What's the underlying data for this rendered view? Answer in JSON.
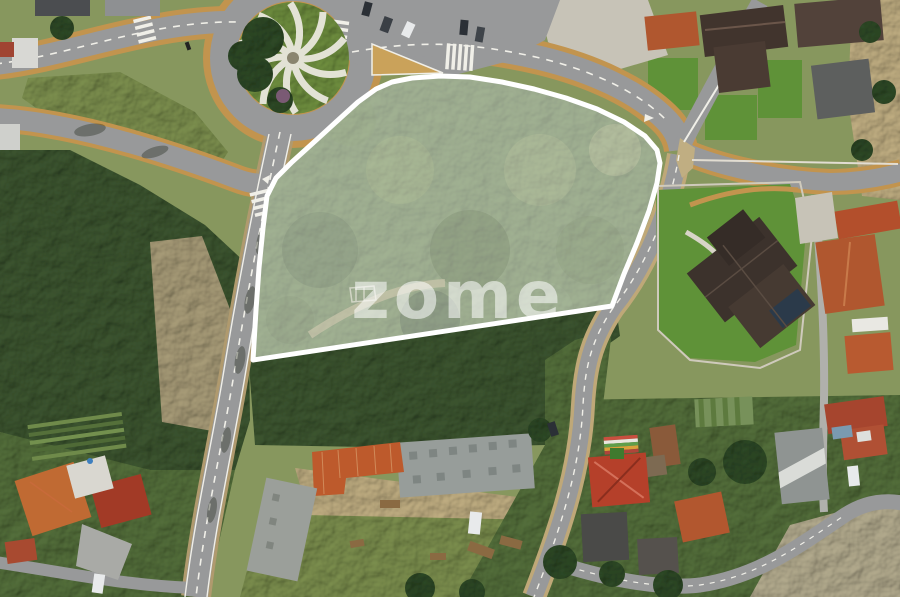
{
  "watermark": {
    "text": "zome"
  },
  "plot": {
    "outline": "253,360 256,310 259,268 263,228 267,196 276,178 292,162 313,143 336,122 358,102 376,89 392,82 412,78 440,76 470,77 502,82 534,89 566,98 597,109 624,122 645,136 657,150 660,163 657,183 649,211 637,243 624,274 612,306"
  },
  "scene": {
    "kind": "aerial-drone-photo",
    "landmarks": [
      "roundabout-with-spiral-island",
      "highlighted-land-plot",
      "forest",
      "warehouse-yard",
      "village-houses",
      "big-house-with-lawn",
      "roads-and-crosswalks"
    ]
  },
  "colors": {
    "asphalt": "#98999a",
    "sidewalk": "#c2944e",
    "roadline": "#f0efe8",
    "forest-dark": "#3c5530",
    "forest-mid": "#546f3b",
    "plot-forest": "#5d7a44",
    "grass-field": "#7c8f4e",
    "lawn": "#5f9238",
    "scrub": "#87975e",
    "dirt": "#c0ae82",
    "rock": "#a89c78",
    "pale": "#c7c3b7",
    "roof-dark": "#41342d",
    "roof-terracotta": "#b0572f",
    "roof-red": "#b5402a",
    "roof-gray": "#979d9a",
    "roof-orange": "#c06a33",
    "warehouse-orange": "#bd5a2c",
    "white-struct": "#e9e8e3",
    "tree-dark": "#2e4926",
    "shadow": "rgba(25,35,20,0.35)",
    "boundary": "#ffffff",
    "overlay": "rgba(255,255,255,0.42)",
    "watermark": "rgba(255,255,255,0.55)",
    "car-dark": "#2b3036",
    "car-white": "#e8eaeb"
  }
}
